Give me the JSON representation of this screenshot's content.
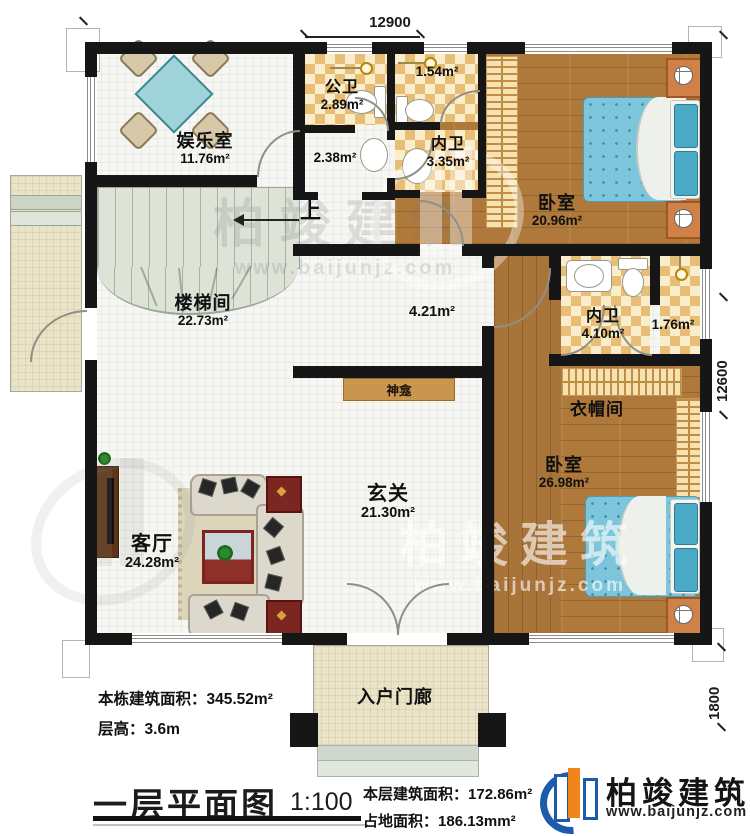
{
  "plan": {
    "title": "一层平面图",
    "scale": "1:100",
    "stair_up": "上",
    "dimensions": {
      "top": "12900",
      "right": "12600",
      "porch_depth": "1800"
    }
  },
  "rooms": {
    "entertainment": {
      "name": "娱乐室",
      "area": "11.76m²"
    },
    "public_bath": {
      "name": "公卫",
      "area": "2.89m²"
    },
    "hall_small": {
      "area": "2.38m²"
    },
    "wc_small": {
      "area": "1.54m²"
    },
    "ensuite_top": {
      "name": "内卫",
      "area": "3.35m²"
    },
    "bedroom_top": {
      "name": "卧室",
      "area": "20.96m²"
    },
    "stairwell": {
      "name": "楼梯间",
      "area": "22.73m²"
    },
    "hallway": {
      "area": "4.21m²"
    },
    "ensuite_mid": {
      "name": "内卫",
      "area": "4.10m²"
    },
    "bath_mid": {
      "area": "1.76m²"
    },
    "cloakroom": {
      "name": "衣帽间"
    },
    "bedroom_bottom": {
      "name": "卧室",
      "area": "26.98m²"
    },
    "shrine": {
      "name": "神龛"
    },
    "foyer": {
      "name": "玄关",
      "area": "21.30m²"
    },
    "living": {
      "name": "客厅",
      "area": "24.28m²"
    },
    "porch": {
      "name": "入户门廊"
    }
  },
  "info": {
    "building_area_label": "本栋建筑面积：",
    "building_area_value": "345.52m²",
    "floor_height_label": "层高：",
    "floor_height_value": "3.6m",
    "floor_area_label": "本层建筑面积：",
    "floor_area_value": "172.86m²",
    "site_area_label": "占地面积：",
    "site_area_value": "186.13mm²"
  },
  "brand": {
    "name": "柏竣建筑",
    "website": "www.baijunjz.com"
  },
  "watermark": {
    "name": "柏竣建筑",
    "website": "www.baijunjz.com"
  },
  "colors": {
    "wall": "#161616",
    "wood": "#ae793b",
    "checker": "#e8bd76",
    "bed_blue": "#7cc5da",
    "stair": "#dde3d7",
    "brand_blue": "#1d5cab",
    "brand_orange": "#f08519"
  }
}
